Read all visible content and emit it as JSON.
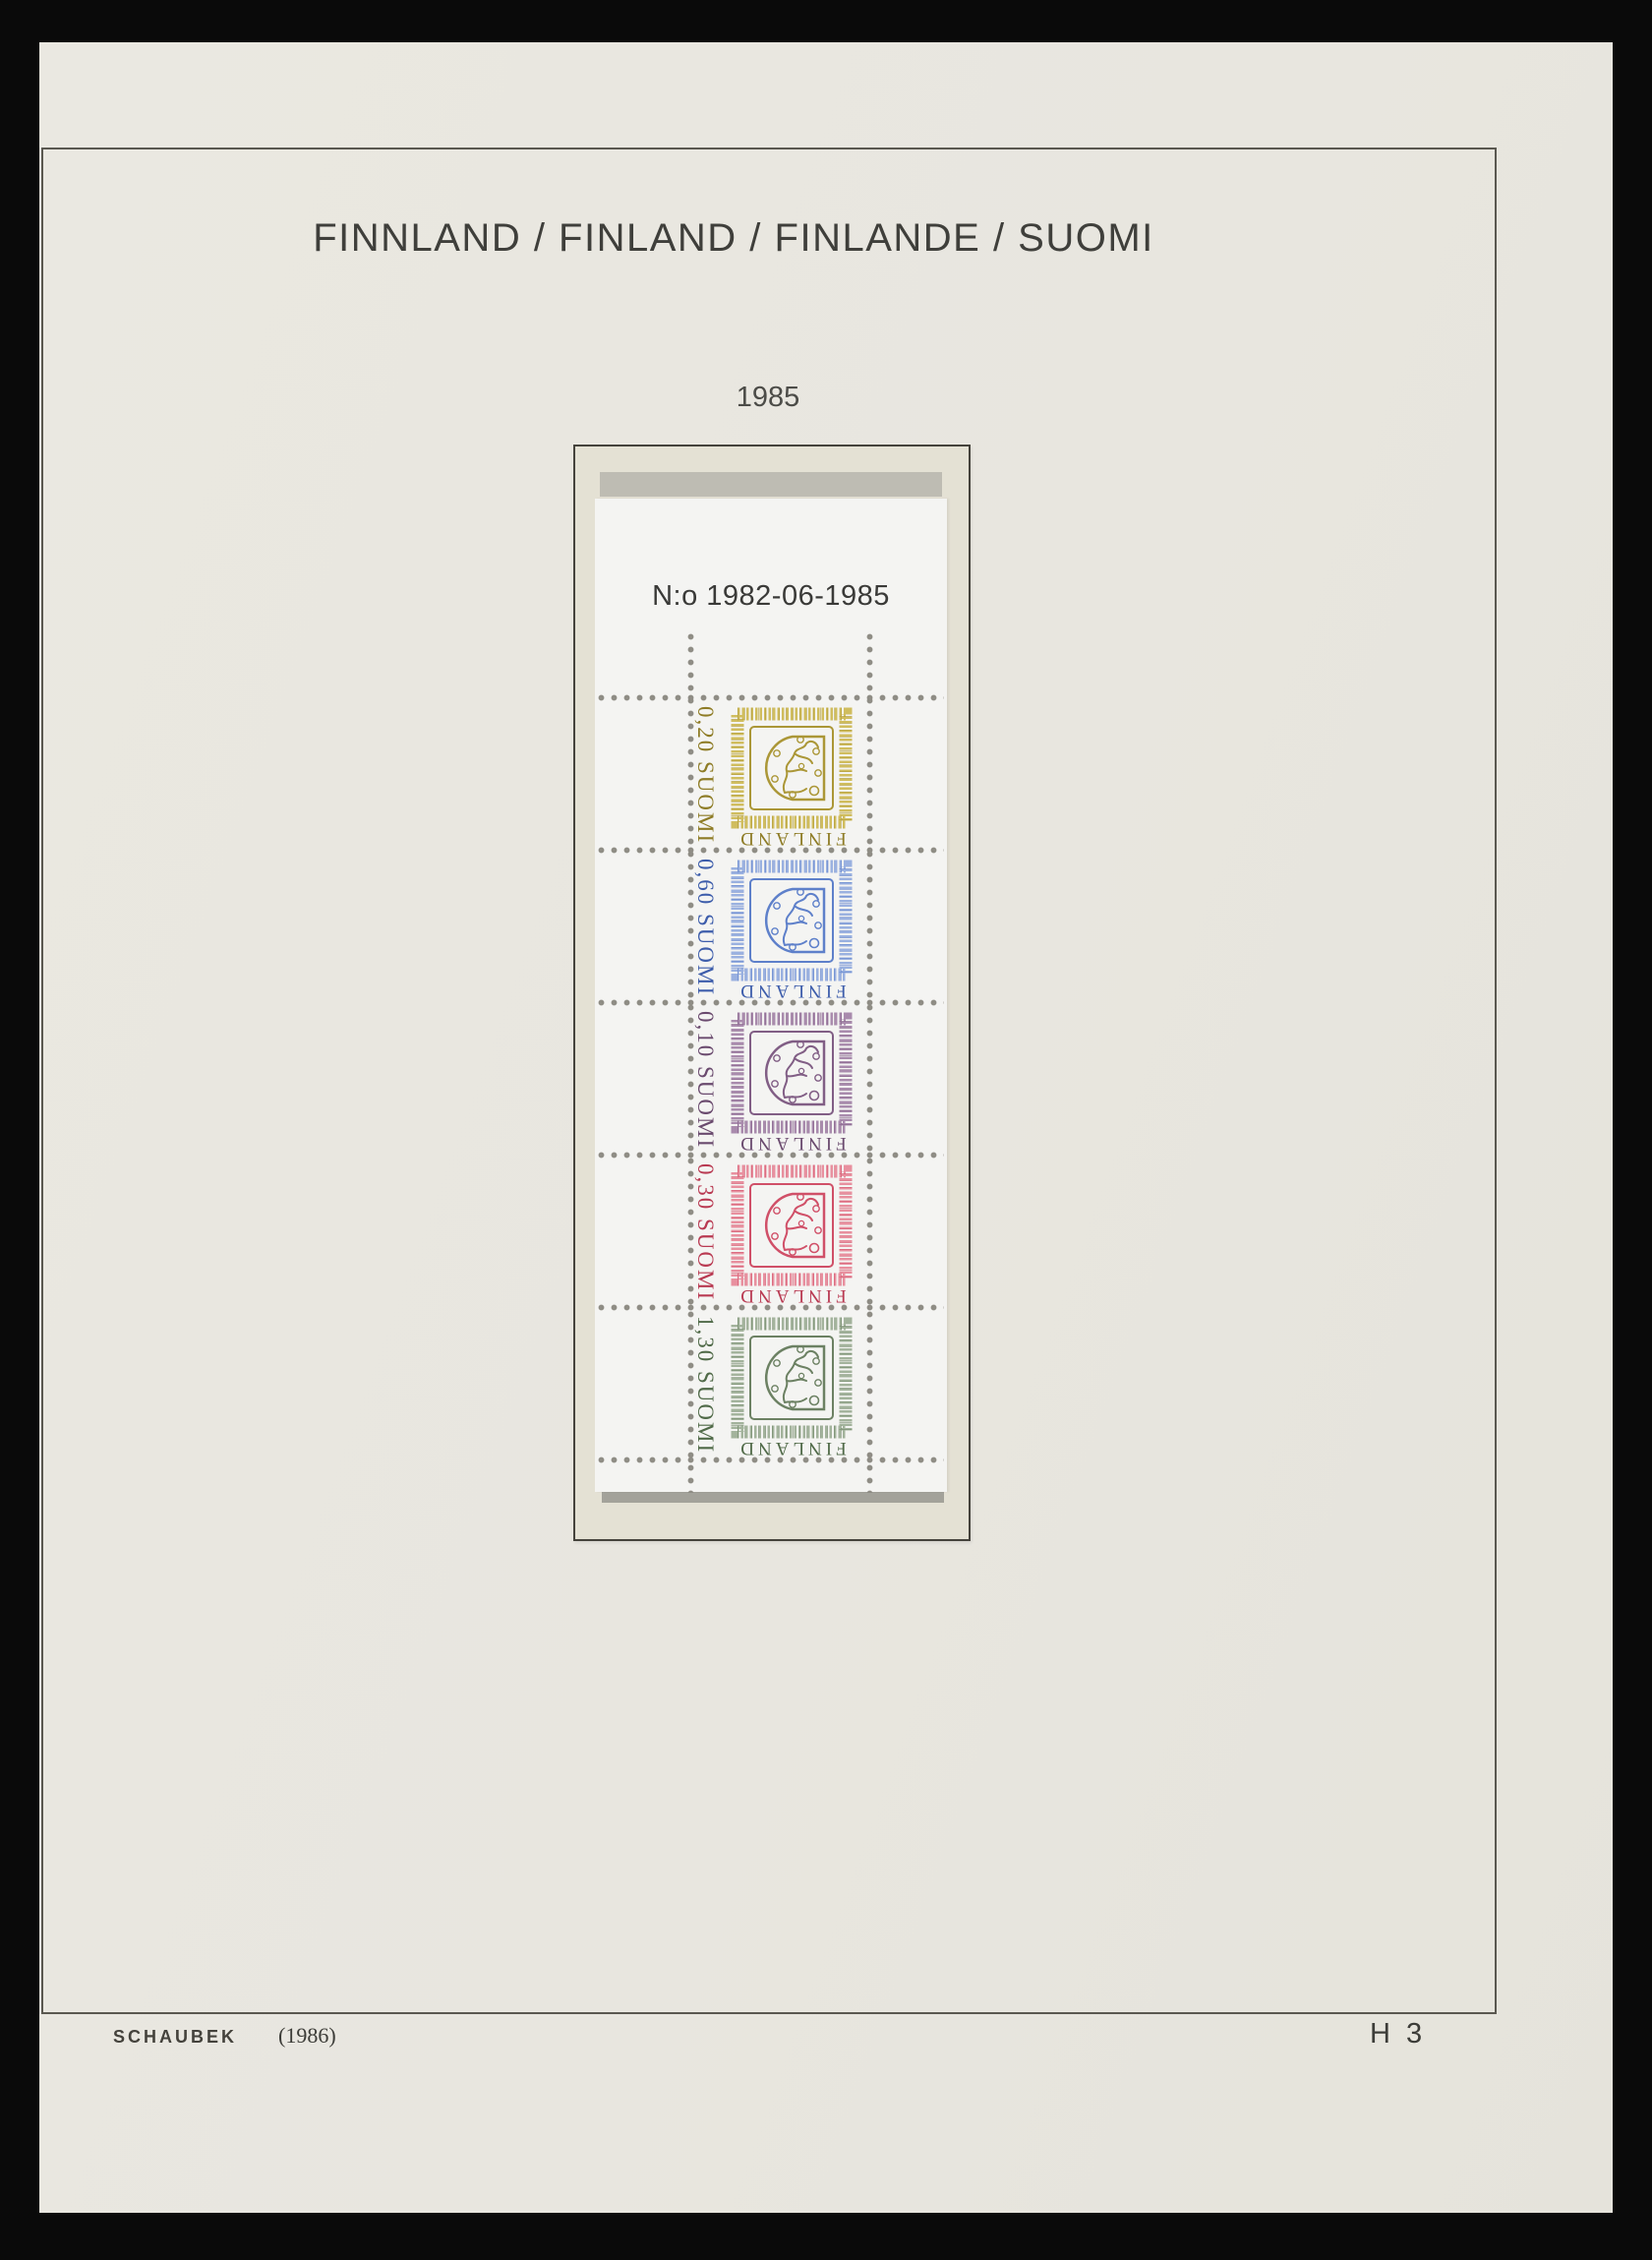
{
  "page": {
    "title": "FINNLAND / FINLAND / FINLANDE / SUOMI",
    "year_label": "1985",
    "footer": {
      "publisher": "SCHAUBEK",
      "edition_note": "(1986)",
      "page_code": "H 3"
    },
    "colors": {
      "paper": "#e8e6df",
      "frame_line": "#5a5850",
      "scan_background": "#0a0a0a"
    }
  },
  "booklet": {
    "header": "N:o 1982-06-1985",
    "mount_colors": {
      "background": "#e4e1d4",
      "border": "#45433c",
      "tab_strip": "#bebcb3",
      "shadow_strip": "#a3a29a"
    },
    "pane_background": "#f4f4f2",
    "perforation_dot_color": "#8f8d85",
    "stamps": [
      {
        "value": "0,20",
        "suomi_label": "SUOMI",
        "finland_label": "FINLAND",
        "color_name": "olive-yellow",
        "colors": {
          "light": "#d0bd5e",
          "mid": "#ab9737",
          "dark": "#8e7c26"
        }
      },
      {
        "value": "0,60",
        "suomi_label": "SUOMI",
        "finland_label": "FINLAND",
        "color_name": "blue",
        "colors": {
          "light": "#9ab1e0",
          "mid": "#5e80ca",
          "dark": "#3d5dab"
        }
      },
      {
        "value": "0,10",
        "suomi_label": "SUOMI",
        "finland_label": "FINLAND",
        "color_name": "violet",
        "colors": {
          "light": "#a98bad",
          "mid": "#815e85",
          "dark": "#6a4a6e"
        }
      },
      {
        "value": "0,30",
        "suomi_label": "SUOMI",
        "finland_label": "FINLAND",
        "color_name": "carmine-rose",
        "colors": {
          "light": "#e8909f",
          "mid": "#d05068",
          "dark": "#b93a52"
        }
      },
      {
        "value": "1,30",
        "suomi_label": "SUOMI",
        "finland_label": "FINLAND",
        "color_name": "grey-green",
        "colors": {
          "light": "#a3b39c",
          "mid": "#6c8163",
          "dark": "#506a48"
        }
      }
    ]
  }
}
